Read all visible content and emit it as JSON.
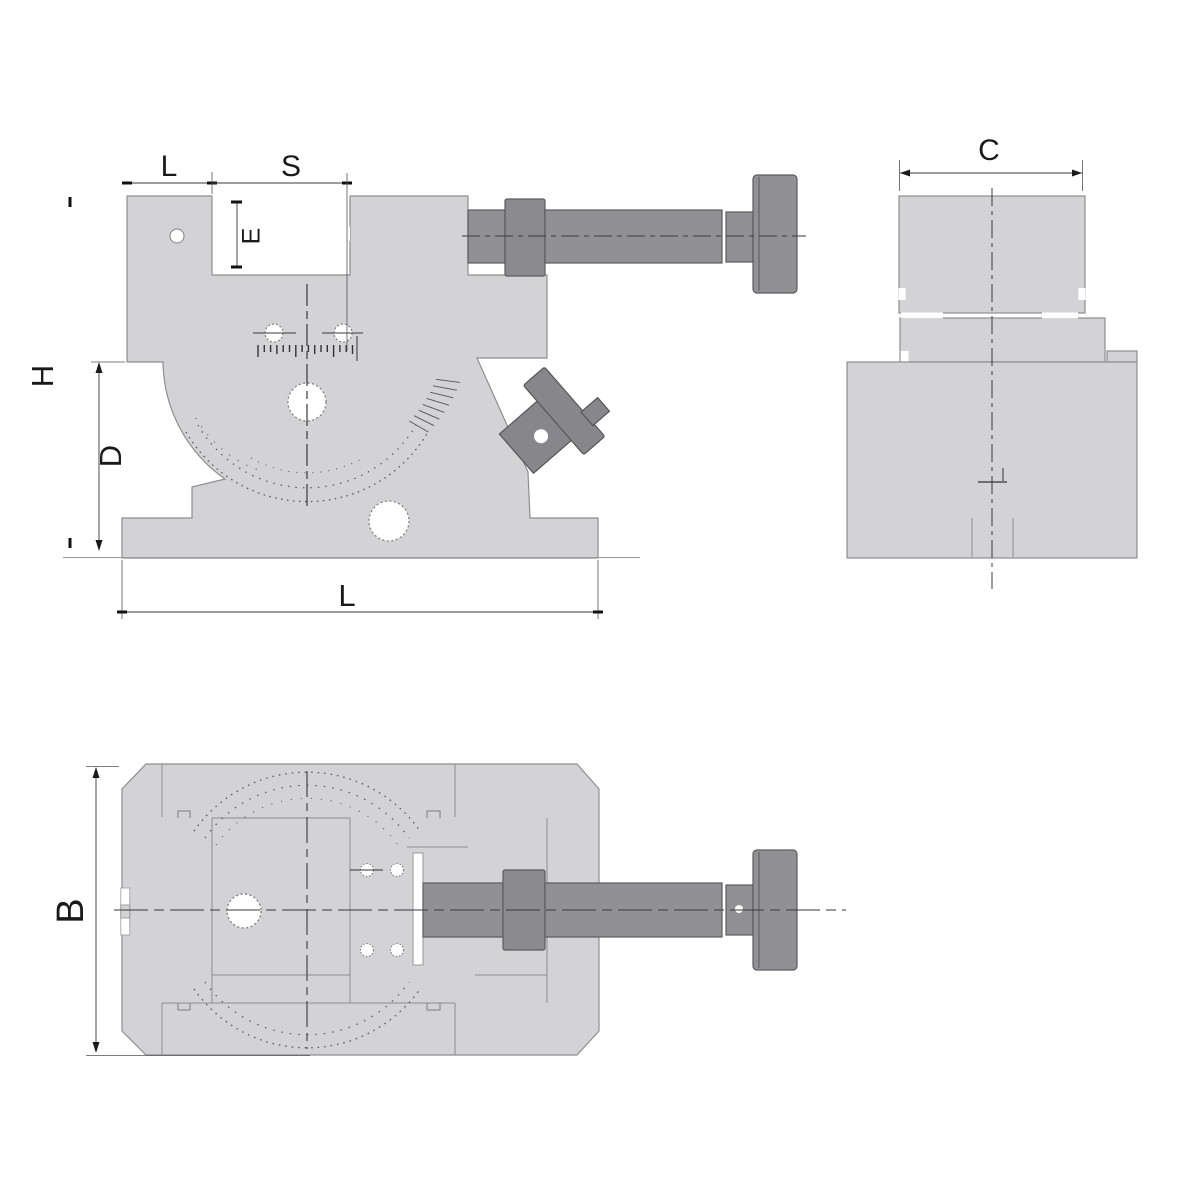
{
  "drawing": {
    "front_view": {
      "labels": {
        "l_top": "L",
        "s": "S",
        "e": "E",
        "h": "H",
        "d": "D",
        "l_bottom": "L"
      }
    },
    "side_view": {
      "labels": {
        "c": "C"
      }
    },
    "plan_view": {
      "labels": {
        "b": "B"
      }
    },
    "colors": {
      "body": "#d3d3d5",
      "hardware": "#919195",
      "outline": "#8e8e93",
      "dimension": "#1a1a1a",
      "background": "#ffffff"
    }
  }
}
